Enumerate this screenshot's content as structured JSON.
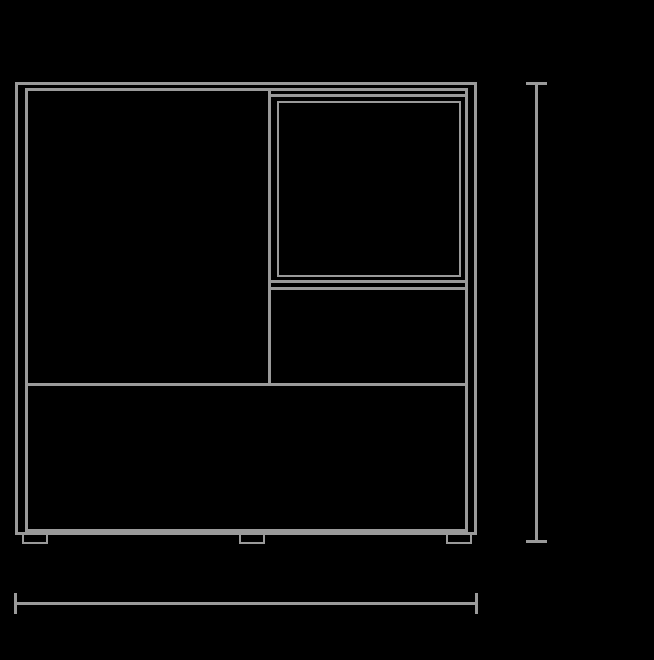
{
  "canvas": {
    "width": 654,
    "height": 660,
    "background_color": "#000000",
    "line_color": "#9a9a9a"
  },
  "drawing": {
    "subject": "cabinet-front-elevation-technical-drawing",
    "shapes": [
      {
        "name": "cabinet-outer-top-edge",
        "kind": "hline",
        "x": 15,
        "y": 82,
        "w": 462,
        "h": 3
      },
      {
        "name": "cabinet-outer-left-edge",
        "kind": "vline",
        "x": 15,
        "y": 82,
        "w": 3,
        "h": 453
      },
      {
        "name": "cabinet-outer-right-edge",
        "kind": "vline",
        "x": 474,
        "y": 82,
        "w": 3,
        "h": 453
      },
      {
        "name": "cabinet-outer-bottom-edge",
        "kind": "hline",
        "x": 15,
        "y": 532,
        "w": 462,
        "h": 3
      },
      {
        "name": "cabinet-inner-top-edge",
        "kind": "hline",
        "x": 25,
        "y": 88,
        "w": 443,
        "h": 3
      },
      {
        "name": "cabinet-inner-left-edge",
        "kind": "vline",
        "x": 25,
        "y": 88,
        "w": 3,
        "h": 444
      },
      {
        "name": "cabinet-inner-right-edge",
        "kind": "vline",
        "x": 465,
        "y": 88,
        "w": 3,
        "h": 444
      },
      {
        "name": "cabinet-inner-bottom-edge",
        "kind": "hline",
        "x": 25,
        "y": 529,
        "w": 443,
        "h": 3
      },
      {
        "name": "center-vertical-divider",
        "kind": "vline",
        "x": 268,
        "y": 88,
        "w": 3,
        "h": 298
      },
      {
        "name": "open-compartment-top-edge",
        "kind": "hline",
        "x": 268,
        "y": 94,
        "w": 200,
        "h": 3
      },
      {
        "name": "open-compartment-inset-panel",
        "kind": "rect",
        "x": 277,
        "y": 101,
        "w": 184,
        "h": 176,
        "t": 2
      },
      {
        "name": "open-compartment-bottom-edge",
        "kind": "hline",
        "x": 268,
        "y": 280,
        "w": 200,
        "h": 3
      },
      {
        "name": "right-drawer-top-edge",
        "kind": "hline",
        "x": 268,
        "y": 287,
        "w": 200,
        "h": 3
      },
      {
        "name": "middle-shelf-divider",
        "kind": "hline",
        "x": 25,
        "y": 383,
        "w": 443,
        "h": 3
      },
      {
        "name": "foot-left",
        "kind": "foot",
        "x": 22,
        "y": 534,
        "w": 26,
        "h": 10,
        "t": 2
      },
      {
        "name": "foot-center",
        "kind": "foot",
        "x": 239,
        "y": 534,
        "w": 26,
        "h": 10,
        "t": 2
      },
      {
        "name": "foot-right",
        "kind": "foot",
        "x": 446,
        "y": 534,
        "w": 26,
        "h": 10,
        "t": 2
      },
      {
        "name": "height-dimension-line",
        "kind": "vline",
        "x": 535,
        "y": 83,
        "w": 3,
        "h": 458
      },
      {
        "name": "height-dimension-cap-top",
        "kind": "hline",
        "x": 526,
        "y": 82,
        "w": 21,
        "h": 3
      },
      {
        "name": "height-dimension-cap-bottom",
        "kind": "hline",
        "x": 526,
        "y": 540,
        "w": 21,
        "h": 3
      },
      {
        "name": "width-dimension-line",
        "kind": "hline",
        "x": 14,
        "y": 602,
        "w": 464,
        "h": 3
      },
      {
        "name": "width-dimension-cap-left",
        "kind": "vline",
        "x": 14,
        "y": 593,
        "w": 3,
        "h": 21
      },
      {
        "name": "width-dimension-cap-right",
        "kind": "vline",
        "x": 475,
        "y": 593,
        "w": 3,
        "h": 21
      }
    ]
  }
}
